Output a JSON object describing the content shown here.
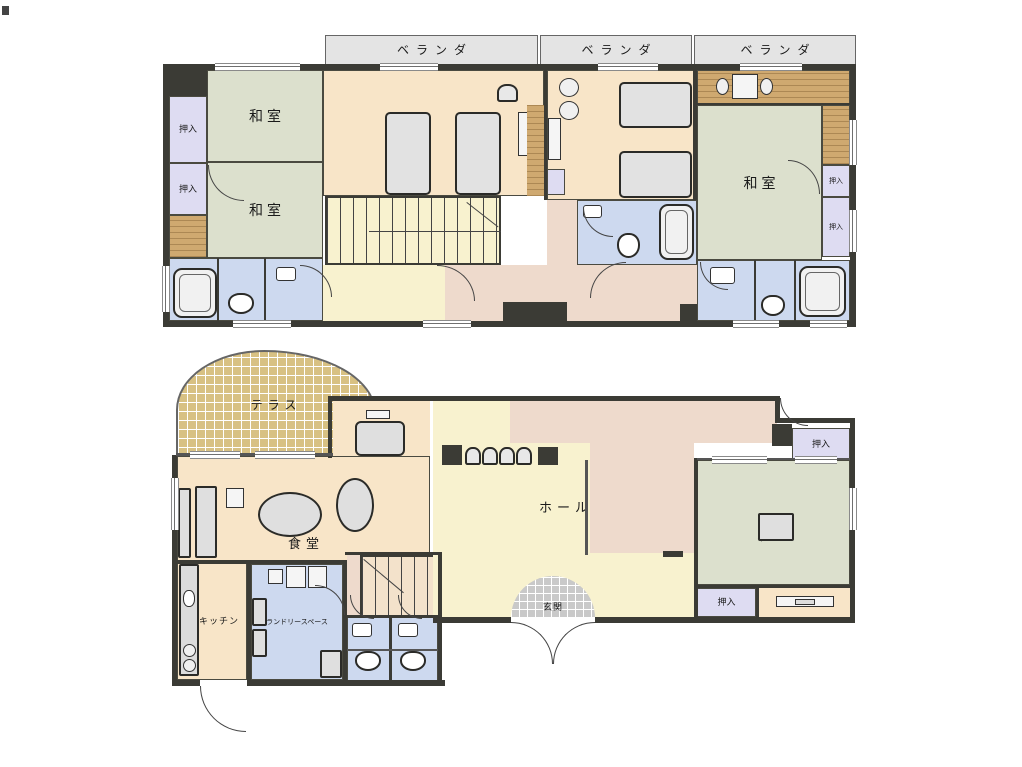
{
  "drawing": {
    "type": "residential floor plan, two floors stacked (2F above, 1F below)",
    "background": "#ffffff"
  },
  "colors": {
    "wall": "#3b3b35",
    "washitsu_room": "#dce0cd",
    "bedroom": "#f8e5c8",
    "corridor": "#eedacc",
    "hall_stairs": "#f8f2cf",
    "closet": "#dedcf2",
    "bathroom": "#cdd9ef",
    "veranda": "#e4e4e4",
    "wood_deck": "#cfa970",
    "terrace_tile": "#d8c183",
    "entrance_tile": "#c9c9c9"
  },
  "floor2": {
    "veranda": [
      "ベランダ",
      "ベランダ",
      "ベランダ"
    ],
    "washitsu_left_top": "和室",
    "washitsu_left_bottom": "和室",
    "washitsu_right": "和室",
    "oshiire": [
      "押入",
      "押入",
      "押入",
      "押入"
    ]
  },
  "floor1": {
    "terrace": "テラス",
    "dining": "食堂",
    "kitchen": "キッチン",
    "laundry": "ランドリースペース",
    "hall": "ホール",
    "entrance": "玄関",
    "washitsu": "和室",
    "oshiire": [
      "押入",
      "押入"
    ]
  }
}
